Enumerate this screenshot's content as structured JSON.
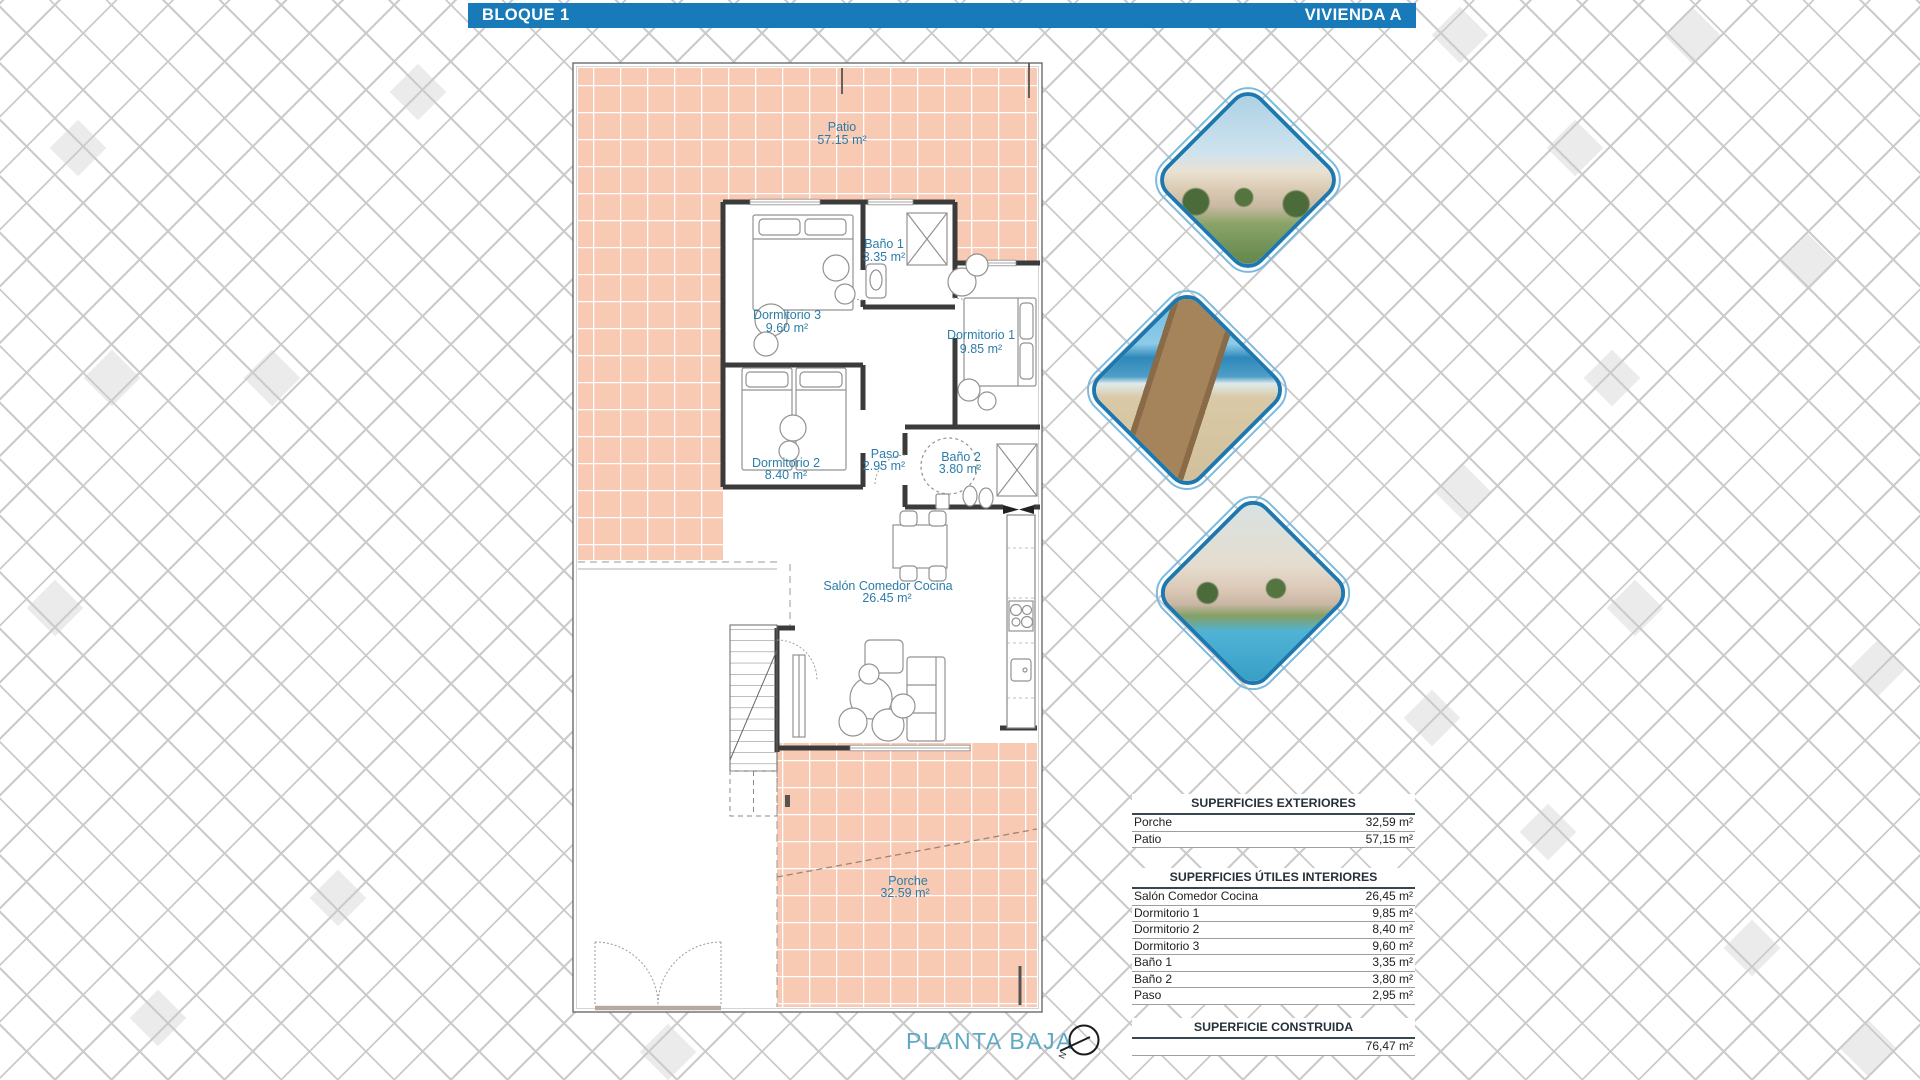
{
  "header": {
    "left_title": "BLOQUE 1",
    "right_title": "VIVIENDA A",
    "bar_color": "#187ab8"
  },
  "plan": {
    "title": "PLANTA BAJA",
    "compass_label": "N",
    "label_color": "#2b7da9",
    "tile_color": "#f8c9b3",
    "rooms": [
      {
        "name": "Patio",
        "area": "57.15 m²"
      },
      {
        "name": "Baño 1",
        "area": "3.35 m²"
      },
      {
        "name": "Dormitorio 3",
        "area": "9.60 m²"
      },
      {
        "name": "Dormitorio 1",
        "area": "9.85 m²"
      },
      {
        "name": "Dormitorio 2",
        "area": "8.40 m²"
      },
      {
        "name": "Paso",
        "area": "2.95 m²"
      },
      {
        "name": "Baño 2",
        "area": "3.80 m²"
      },
      {
        "name": "Salón Comedor Cocina",
        "area": "26.45 m²"
      },
      {
        "name": "Porche",
        "area": "32.59 m²"
      }
    ]
  },
  "gallery": {
    "images": [
      {
        "icon": "apartments-render-photo"
      },
      {
        "icon": "beach-boardwalk-photo"
      },
      {
        "icon": "pool-garden-photo"
      }
    ]
  },
  "tables": {
    "exteriores": {
      "title": "SUPERFICIES EXTERIORES",
      "rows": [
        {
          "label": "Porche",
          "value": "32,59 m²"
        },
        {
          "label": "Patio",
          "value": "57,15 m²"
        }
      ]
    },
    "interiores": {
      "title": "SUPERFICIES ÚTILES INTERIORES",
      "rows": [
        {
          "label": "Salón Comedor Cocina",
          "value": "26,45 m²"
        },
        {
          "label": "Dormitorio 1",
          "value": "9,85 m²"
        },
        {
          "label": "Dormitorio 2",
          "value": "8,40 m²"
        },
        {
          "label": "Dormitorio 3",
          "value": "9,60 m²"
        },
        {
          "label": "Baño 1",
          "value": "3,35 m²"
        },
        {
          "label": "Baño 2",
          "value": "3,80 m²"
        },
        {
          "label": "Paso",
          "value": "2,95 m²"
        }
      ]
    },
    "construida": {
      "title": "SUPERFICIE CONSTRUIDA",
      "value": "76,47 m²"
    }
  }
}
